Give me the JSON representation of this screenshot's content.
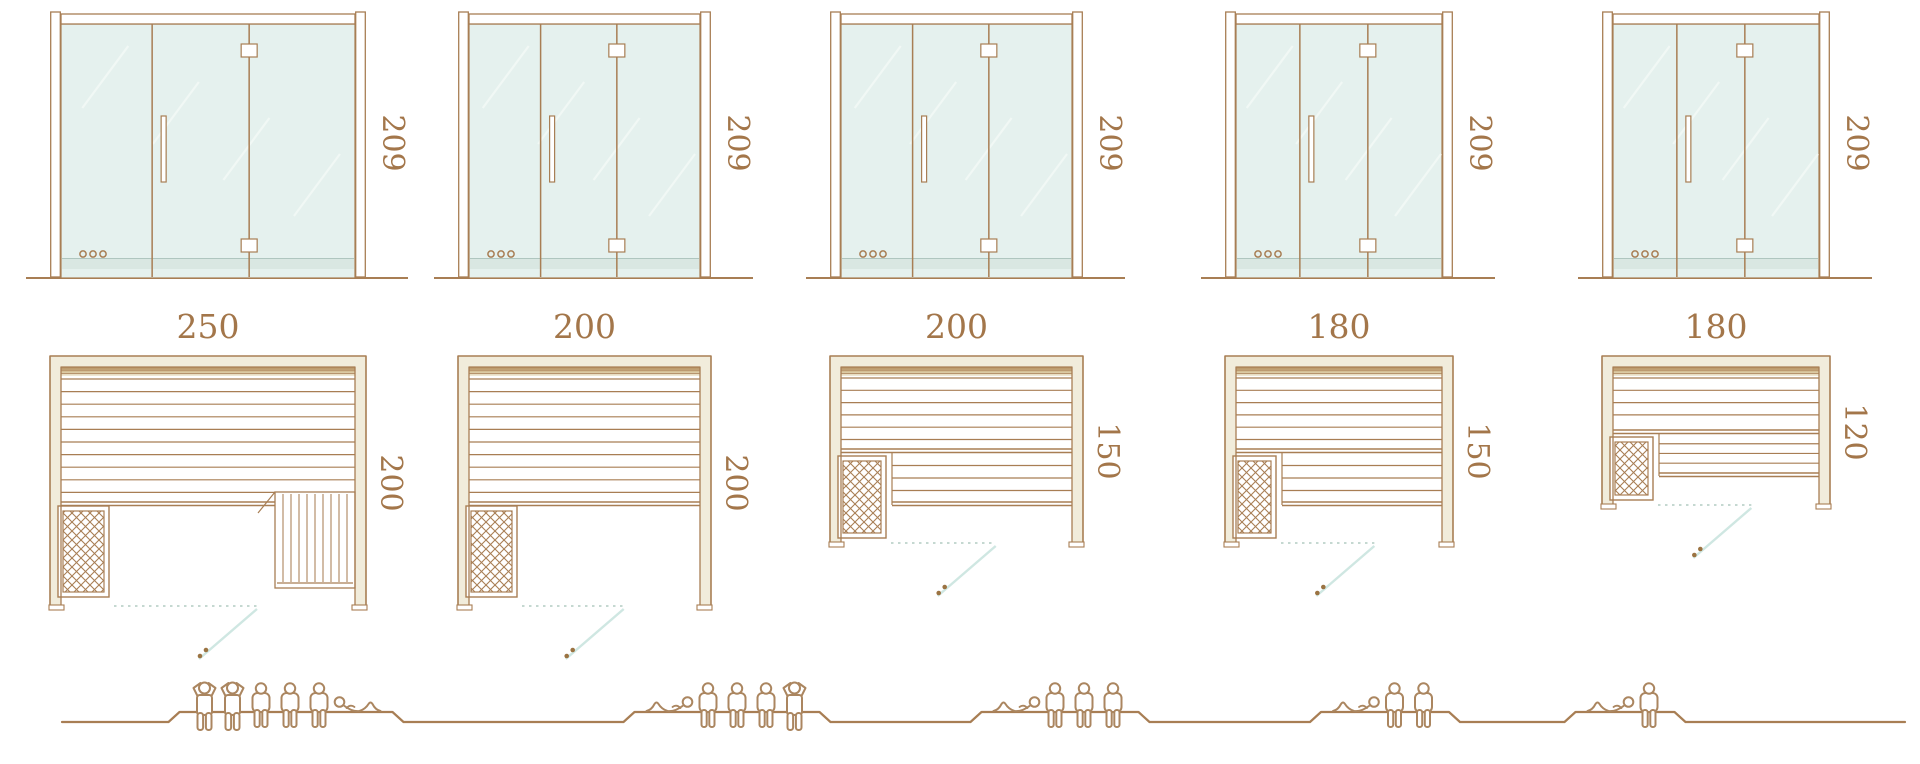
{
  "diagram": {
    "kind": "sauna-cabin-size-comparison",
    "rows": [
      "glass-front-elevation",
      "floor-plan",
      "seating-capacity"
    ]
  },
  "colors": {
    "line_brown": "#a87e54",
    "label_brown": "#a3764a",
    "figure_brown": "#ab8660",
    "glass_fill": "#e5f1ee",
    "glass_streak": "#f1f8f5",
    "glass_bottom_band": "#d9e7e2",
    "frame_cream": "#f1ecdb",
    "backrest_tan": "#b28a5a",
    "dotted_front_line": "#c5d8d1",
    "door_swing_line": "#cfe7e2",
    "handle_dots": "#9b7342"
  },
  "units": [
    {
      "door_height_label": "209",
      "width_label": "250",
      "depth_label": "200",
      "width_cm": 250,
      "depth_cm": 200,
      "bench_layout": "l-shaped-with-side-bench",
      "capacity": {
        "standing": 2,
        "sitting": 3,
        "reclining": 1,
        "total": 6
      },
      "figures": [
        "standing",
        "standing",
        "sitting",
        "sitting",
        "sitting",
        "reclining"
      ]
    },
    {
      "door_height_label": "209",
      "width_label": "200",
      "depth_label": "200",
      "width_cm": 200,
      "depth_cm": 200,
      "bench_layout": "full-width-bench",
      "capacity": {
        "standing": 1,
        "sitting": 3,
        "reclining": 1,
        "total": 5
      },
      "figures": [
        "reclining",
        "sitting",
        "sitting",
        "sitting",
        "standing"
      ]
    },
    {
      "door_height_label": "209",
      "width_label": "200",
      "depth_label": "150",
      "width_cm": 200,
      "depth_cm": 150,
      "bench_layout": "two-tier-bench",
      "capacity": {
        "standing": 0,
        "sitting": 3,
        "reclining": 1,
        "total": 4
      },
      "figures": [
        "reclining",
        "sitting",
        "sitting",
        "sitting"
      ]
    },
    {
      "door_height_label": "209",
      "width_label": "180",
      "depth_label": "150",
      "width_cm": 180,
      "depth_cm": 150,
      "bench_layout": "two-tier-bench",
      "capacity": {
        "standing": 0,
        "sitting": 2,
        "reclining": 1,
        "total": 3
      },
      "figures": [
        "reclining",
        "sitting",
        "sitting"
      ]
    },
    {
      "door_height_label": "209",
      "width_label": "180",
      "depth_label": "120",
      "width_cm": 180,
      "depth_cm": 120,
      "bench_layout": "two-tier-bench",
      "capacity": {
        "standing": 0,
        "sitting": 1,
        "reclining": 1,
        "total": 2
      },
      "figures": [
        "reclining",
        "sitting"
      ]
    }
  ]
}
